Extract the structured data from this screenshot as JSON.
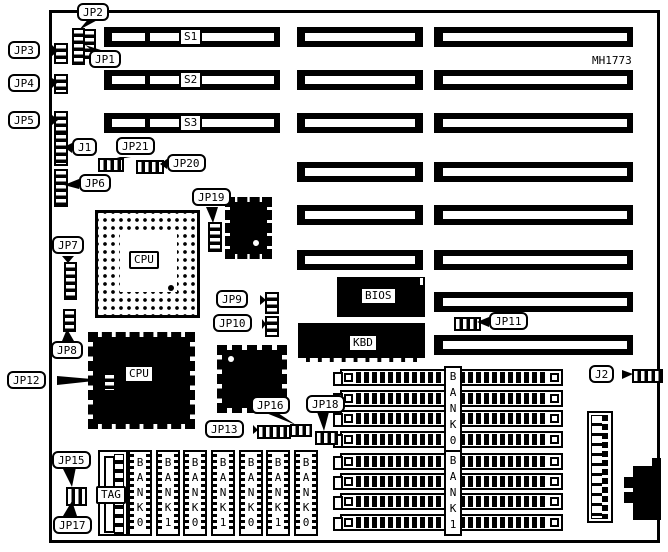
{
  "board": {
    "part_number": "MH1773"
  },
  "slots": {
    "s1": "S1",
    "s2": "S2",
    "s3": "S3"
  },
  "chips": {
    "cpu1": "CPU",
    "cpu2": "CPU",
    "bios": "BIOS",
    "kbd": "KBD"
  },
  "jumpers": {
    "jp1": "JP1",
    "jp2": "JP2",
    "jp3": "JP3",
    "jp4": "JP4",
    "jp5": "JP5",
    "jp6": "JP6",
    "jp7": "JP7",
    "jp8": "JP8",
    "jp9": "JP9",
    "jp10": "JP10",
    "jp11": "JP11",
    "jp12": "JP12",
    "jp13": "JP13",
    "jp15": "JP15",
    "jp16": "JP16",
    "jp17": "JP17",
    "jp18": "JP18",
    "jp19": "JP19",
    "jp20": "JP20",
    "jp21": "JP21",
    "j1": "J1",
    "j2": "J2"
  },
  "memory": {
    "tag_label": "TAG",
    "simm_groups": [
      {
        "label": "BANK0"
      },
      {
        "label": "BANK1"
      }
    ],
    "sram_banks": [
      "BANK0",
      "BANK1",
      "BANK0",
      "BANK1",
      "BANK0",
      "BANK1",
      "BANK0"
    ]
  }
}
